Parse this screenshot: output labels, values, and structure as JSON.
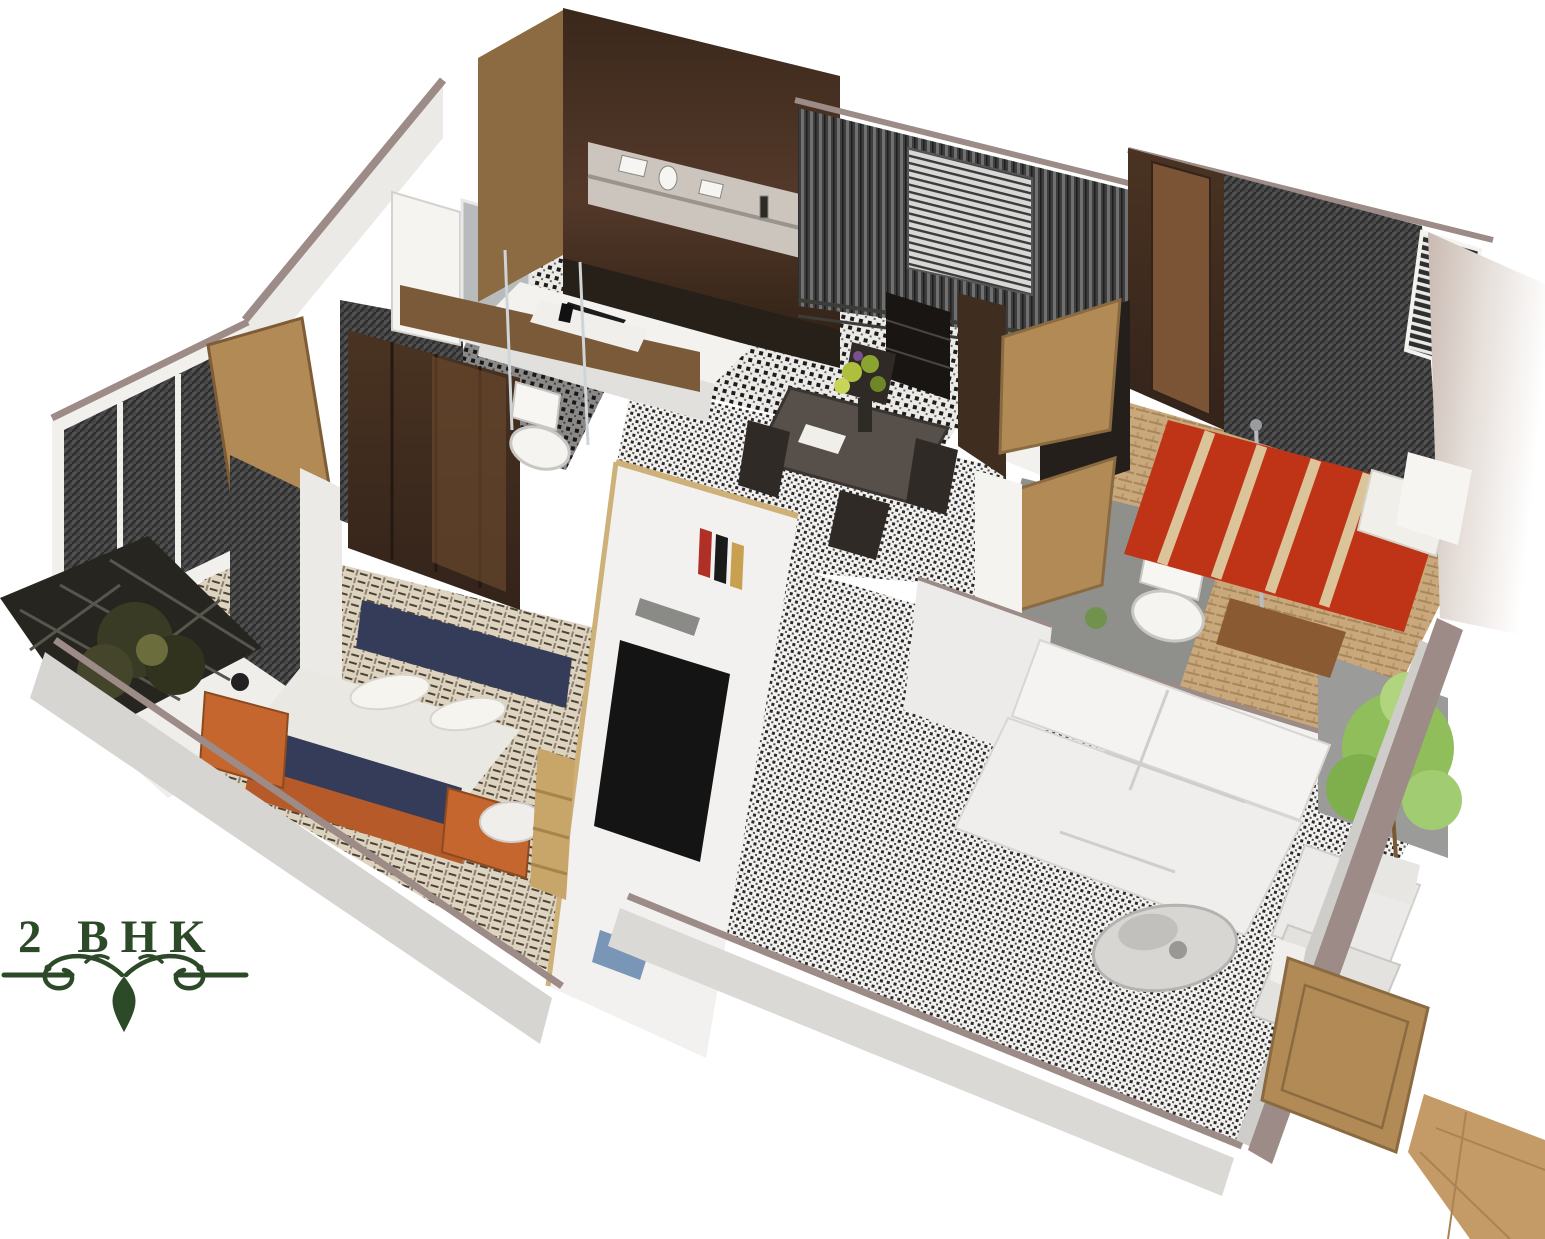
{
  "title": {
    "text": "2 BHK"
  },
  "ornament": "floral-flourish-divider",
  "colors": {
    "background": "#ffffff",
    "text_green": "#2d4a28",
    "wall_top": "#9c8b86",
    "wall_face": "#eceae7",
    "wood_dark": "#44301f",
    "wood_mid": "#7a5a38",
    "door_tan": "#b28a56",
    "curtain_gray": "#474747",
    "bed_navy": "#353c59",
    "blanket_white": "#eae8e2",
    "nightstand_orange": "#c4662e",
    "bed_red": "#bf3317",
    "bed_stripe": "#dcc49a",
    "sofa_white": "#efeeec",
    "plant_green": "#8fbe5b",
    "floor_beige": "#ded3bf",
    "floor_wood": "#c9a87c",
    "bath_floor_gray": "#8f8f8b",
    "entrance_floor_tan": "#c49a66"
  },
  "rooms": [
    "kitchen",
    "utility-balcony",
    "dining-area",
    "master-bedroom",
    "ensuite-bathroom",
    "common-bathroom",
    "second-bedroom",
    "west-balcony",
    "living-room",
    "entrance-foyer"
  ],
  "furniture": [
    "kitchen-shelf-unit",
    "kitchen-island-hob",
    "dining-table",
    "dining-chairs",
    "flower-vase",
    "tall-shelf",
    "navy-double-bed",
    "orange-nightstands",
    "tv-panel",
    "bookshelf-books",
    "wardrobes",
    "toilets",
    "wash-basin",
    "red-striped-double-bed",
    "bed-bench",
    "white-l-sofa",
    "armchairs",
    "coffee-table",
    "potted-plant",
    "balcony-plant",
    "open-doors"
  ]
}
